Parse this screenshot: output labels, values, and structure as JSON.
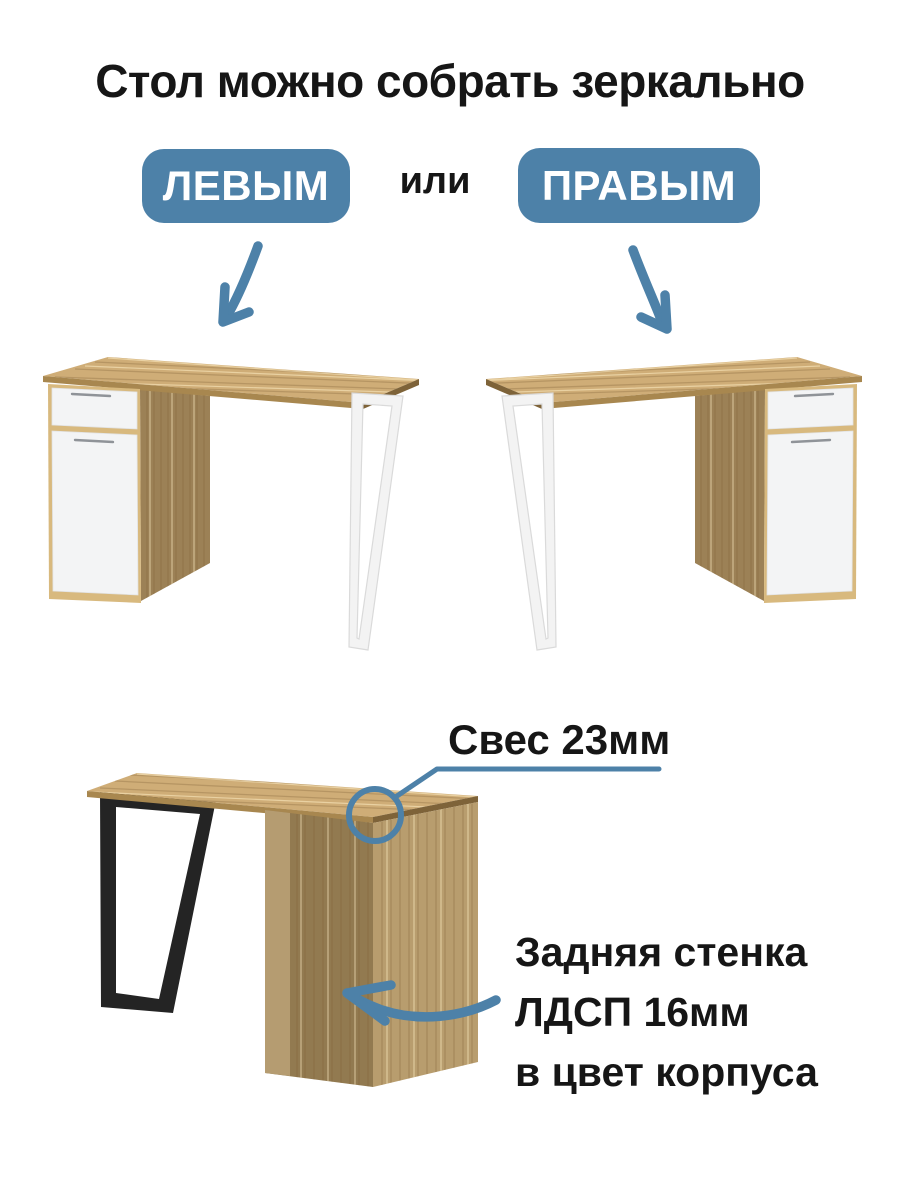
{
  "colors": {
    "accent": "#4d81a8",
    "ink": "#161616",
    "wood-top": "#cfad77",
    "wood-grain": "#7d6136",
    "wood-edge-front": "#a8874f",
    "wood-edge-end": "#7e6339",
    "wood-side": "#9c8156",
    "wood-side-light": "#b59c71",
    "wood-back": "#927a50",
    "wood-right": "#b89d6e",
    "oak-frame": "#d8b97e",
    "panel-white": "#f3f4f5",
    "panel-stroke": "#e2e3e4",
    "handle": "#8f9398",
    "leg-white": "#f3f3f3",
    "leg-white-edge": "#dadada",
    "leg-black": "#242424"
  },
  "header": {
    "title": "Стол можно собрать зеркально"
  },
  "options": {
    "left_badge": "ЛЕВЫМ",
    "separator": "или",
    "right_badge": "ПРАВЫМ"
  },
  "annotations": {
    "overhang_label": "Свес 23мм",
    "back_panel_lines": [
      "Задняя стенка",
      "ЛДСП 16мм",
      "в цвет корпуса"
    ]
  }
}
